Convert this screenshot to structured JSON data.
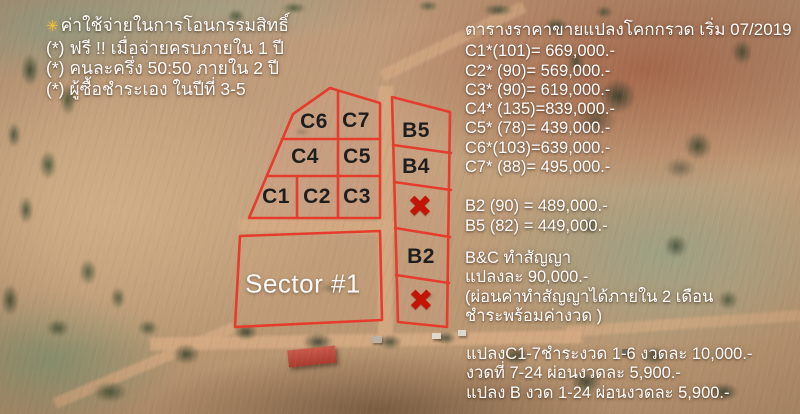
{
  "notes": {
    "bullet": "✳",
    "line1": "ค่าใช้จ่ายในการโอนกรรมสิทธิ์",
    "line2": "(*) ฟรี !! เมื่อจ่ายครบภายใน 1 ปี",
    "line3": "(*) คนละครึ่ง 50:50 ภายใน 2 ปี",
    "line4": "(*) ผู้ซื้อชำระเอง ในปีที่ 3-5"
  },
  "price_list": {
    "title": "ตารางราคาขายแปลงโคกกรวด เริ่ม 07/2019",
    "rows": [
      "C1*(101)= 669,000.-",
      "C2* (90)= 569,000.-",
      "C3* (90)= 619,000.-",
      "C4* (135)=839,000.-",
      "C5* (78)= 439,000.-",
      "C6*(103)=639,000.-",
      "C7* (88)= 495,000.-"
    ],
    "rows_b": [
      "B2 (90) = 489,000.-",
      "B5 (82) = 449,000.-"
    ],
    "contract": [
      "B&C  ทำสัญญา",
      "แปลงละ 90,000.-",
      "(ผ่อนค่าทำสัญญาได้ภายใน 2 เดือน",
      "ชำระพร้อมค่างวด )"
    ],
    "installments": [
      "แปลงC1-7ชำระงวด 1-6 งวดละ 10,000.-",
      "งวดที่ 7-24 ผ่อนงวดละ 5,900.-",
      "แปลง B งวด 1-24 ผ่อนงวดละ 5,900.-"
    ]
  },
  "map": {
    "sector_label": "Sector #1",
    "sold_mark": "✖",
    "plots": {
      "c1": "C1",
      "c2": "C2",
      "c3": "C3",
      "c4": "C4",
      "c5": "C5",
      "c6": "C6",
      "c7": "C7",
      "b2": "B2",
      "b4": "B4",
      "b5": "B5"
    }
  },
  "colors": {
    "boundary_red": "#e63c2e",
    "sold_x_red": "#c21508",
    "label_dark": "#1e1e1e",
    "overlay_text": "#ffffff"
  }
}
